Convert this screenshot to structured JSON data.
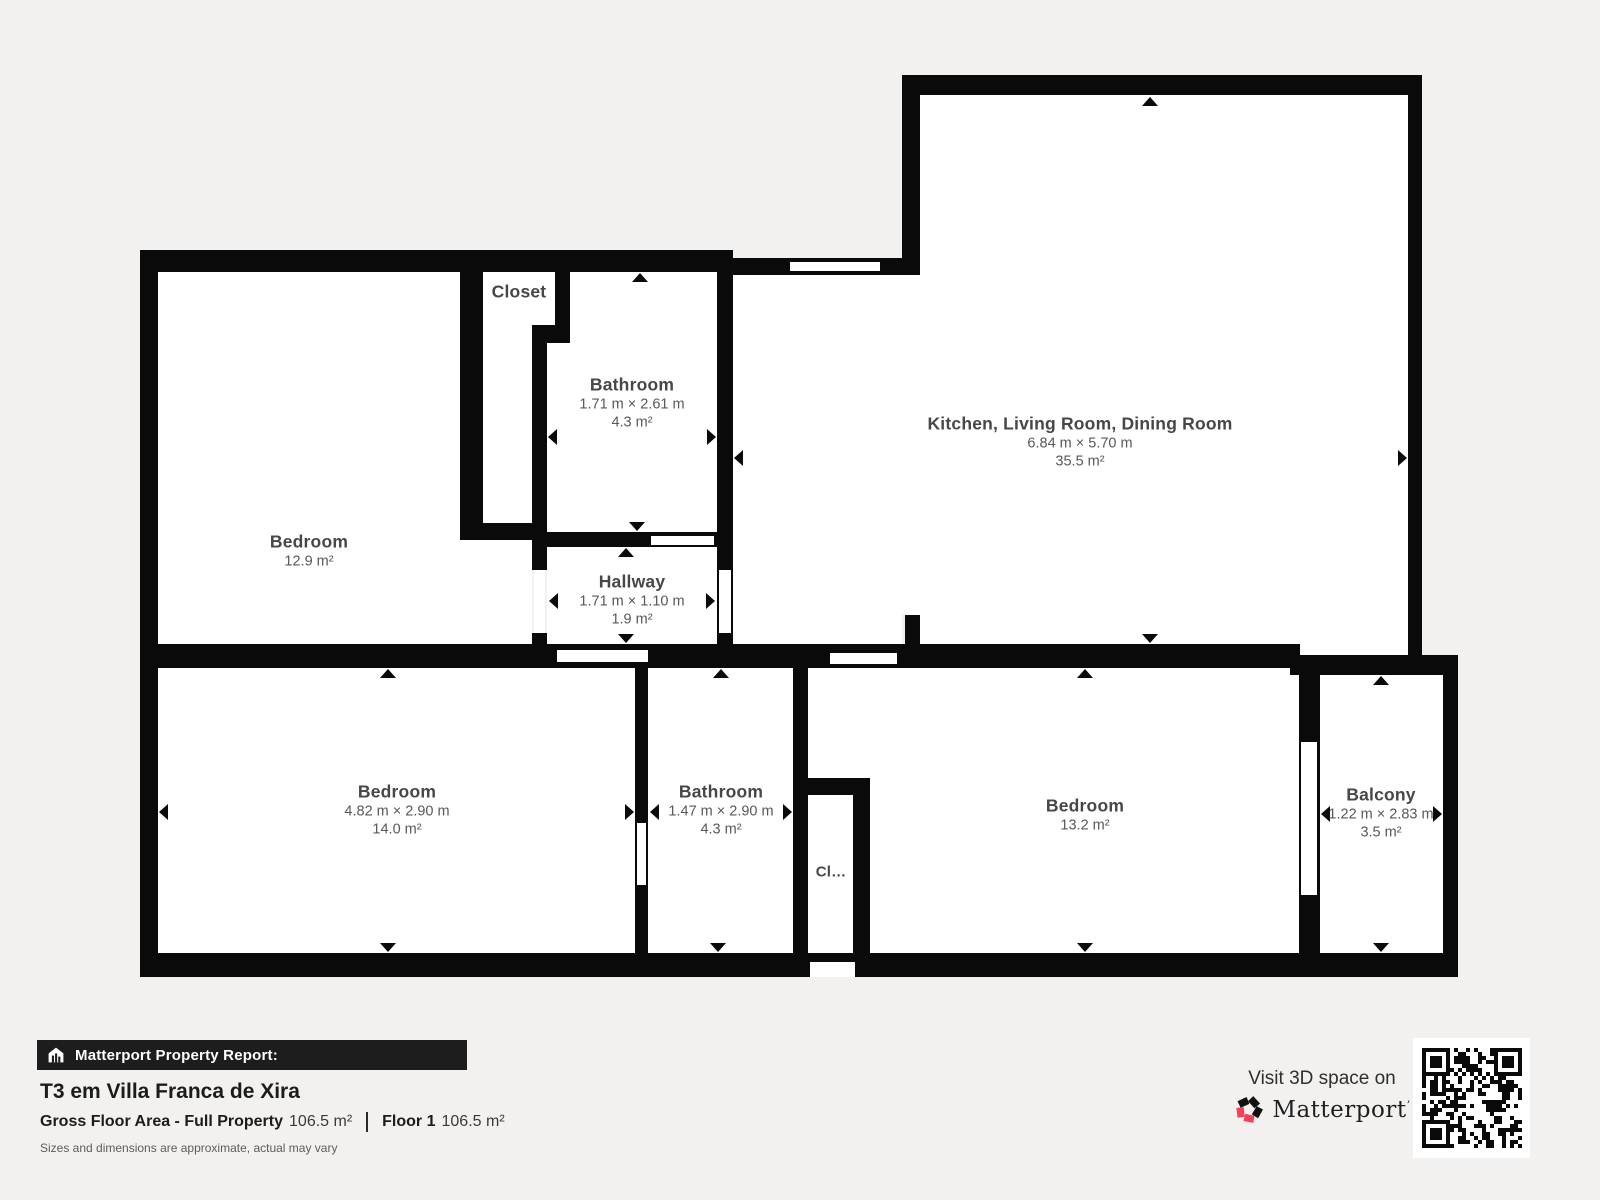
{
  "meta": {
    "background_color": "#f2f1ef",
    "wall_color": "#0a0a0a",
    "room_fill": "#ffffff",
    "brand_pink": "#f4415c"
  },
  "floorplan": {
    "rooms": [
      {
        "id": "bedroom-1",
        "name": "Bedroom",
        "area": "12.9 m²"
      },
      {
        "id": "closet-1",
        "name": "Closet"
      },
      {
        "id": "bathroom-1",
        "name": "Bathroom",
        "dims": "1.71 m × 2.61 m",
        "area": "4.3 m²"
      },
      {
        "id": "hallway",
        "name": "Hallway",
        "dims": "1.71 m × 1.10 m",
        "area": "1.9 m²"
      },
      {
        "id": "kitchen-living-dining",
        "name": "Kitchen, Living Room, Dining Room",
        "dims": "6.84 m × 5.70 m",
        "area": "35.5 m²"
      },
      {
        "id": "bedroom-2",
        "name": "Bedroom",
        "dims": "4.82 m × 2.90 m",
        "area": "14.0 m²"
      },
      {
        "id": "bathroom-2",
        "name": "Bathroom",
        "dims": "1.47 m × 2.90 m",
        "area": "4.3 m²"
      },
      {
        "id": "closet-2",
        "name": "Cl…"
      },
      {
        "id": "bedroom-3",
        "name": "Bedroom",
        "area": "13.2 m²"
      },
      {
        "id": "balcony",
        "name": "Balcony",
        "dims": "1.22 m × 2.83 m",
        "area": "3.5 m²"
      }
    ]
  },
  "footer": {
    "report_label": "Matterport Property Report:",
    "property_title": "T3 em Villa Franca de Xira",
    "gross_floor_area_label": "Gross Floor Area - Full Property",
    "gross_floor_area_value": "106.5 m²",
    "floor_label": "Floor 1",
    "floor_value": "106.5 m²",
    "disclaimer": "Sizes and dimensions are approximate, actual may vary"
  },
  "cta": {
    "visit_text": "Visit 3D space on",
    "brand": "Matterport",
    "trademark": "’"
  }
}
